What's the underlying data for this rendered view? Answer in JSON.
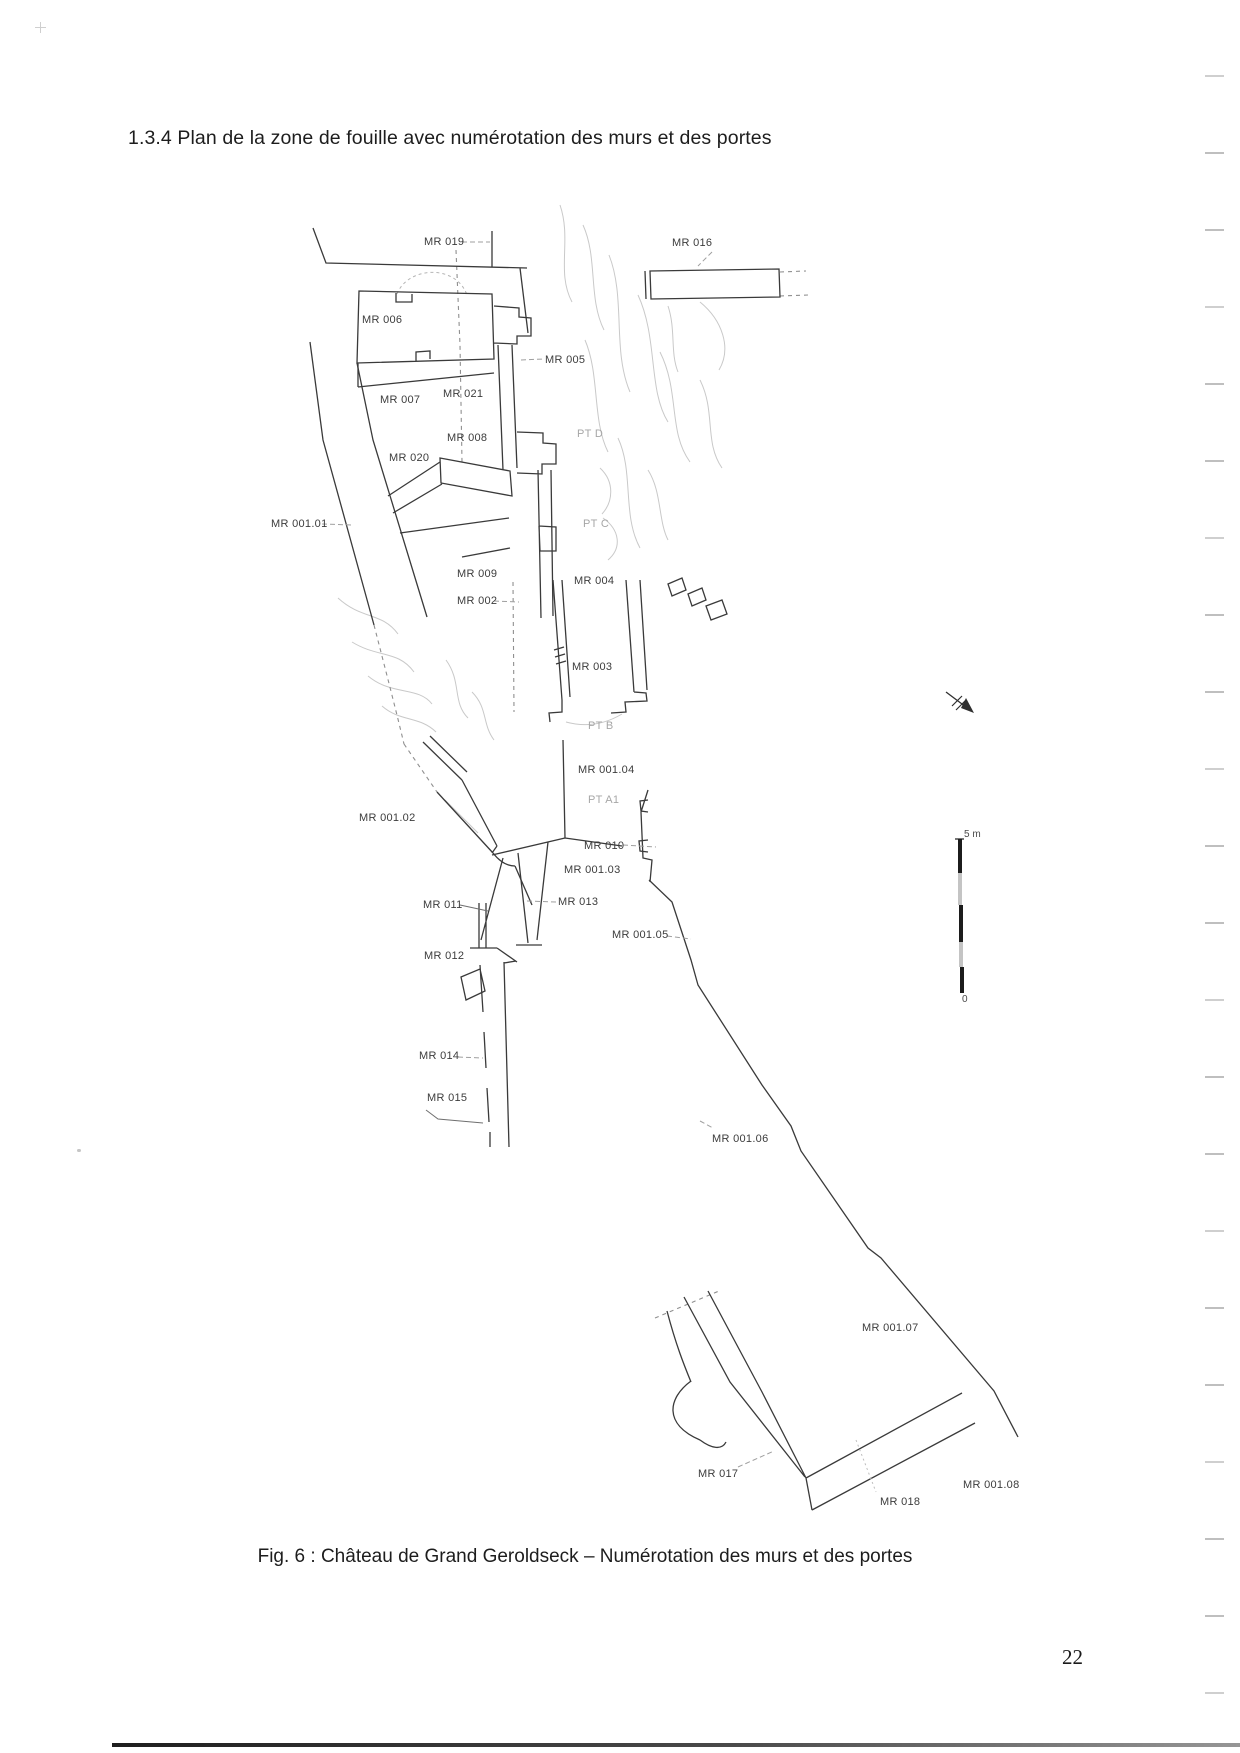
{
  "page": {
    "heading": "1.3.4 Plan de la zone de fouille avec numérotation des murs et des portes",
    "caption": "Fig. 6 : Château de Grand Geroldseck – Numérotation des murs et des portes",
    "page_number": "22",
    "scan_artifacts": {
      "edge_dash_count": 22,
      "edge_dash_start_y": 75,
      "edge_dash_step_y": 77
    }
  },
  "figure": {
    "type": "excavation-plan-line-drawing",
    "has_north_arrow": true,
    "scale_bar": {
      "top_label": "5 m",
      "bottom_label": "0",
      "length_m": 5
    },
    "labels": [
      {
        "name": "label-mr-019",
        "text": "MR 019",
        "x": 424,
        "y": 236,
        "tone": "dark"
      },
      {
        "name": "label-mr-016",
        "text": "MR 016",
        "x": 672,
        "y": 237,
        "tone": "dark"
      },
      {
        "name": "label-mr-006",
        "text": "MR 006",
        "x": 362,
        "y": 314,
        "tone": "dark"
      },
      {
        "name": "label-mr-005",
        "text": "MR 005",
        "x": 545,
        "y": 354,
        "tone": "dark"
      },
      {
        "name": "label-mr-007",
        "text": "MR 007",
        "x": 380,
        "y": 394,
        "tone": "dark"
      },
      {
        "name": "label-mr-021",
        "text": "MR 021",
        "x": 443,
        "y": 388,
        "tone": "dark"
      },
      {
        "name": "label-mr-008",
        "text": "MR 008",
        "x": 447,
        "y": 432,
        "tone": "dark"
      },
      {
        "name": "label-mr-020",
        "text": "MR 020",
        "x": 389,
        "y": 452,
        "tone": "dark"
      },
      {
        "name": "label-pt-d",
        "text": "PT D",
        "x": 577,
        "y": 428,
        "tone": "light"
      },
      {
        "name": "label-mr-001-01",
        "text": "MR 001.01",
        "x": 271,
        "y": 518,
        "tone": "dark"
      },
      {
        "name": "label-pt-c",
        "text": "PT C",
        "x": 583,
        "y": 518,
        "tone": "light"
      },
      {
        "name": "label-mr-009",
        "text": "MR 009",
        "x": 457,
        "y": 568,
        "tone": "dark"
      },
      {
        "name": "label-mr-004",
        "text": "MR 004",
        "x": 574,
        "y": 575,
        "tone": "dark"
      },
      {
        "name": "label-mr-002",
        "text": "MR 002",
        "x": 457,
        "y": 595,
        "tone": "dark"
      },
      {
        "name": "label-mr-003",
        "text": "MR 003",
        "x": 572,
        "y": 661,
        "tone": "dark"
      },
      {
        "name": "label-pt-b",
        "text": "PT B",
        "x": 588,
        "y": 720,
        "tone": "light"
      },
      {
        "name": "label-mr-001-04",
        "text": "MR 001.04",
        "x": 578,
        "y": 764,
        "tone": "dark"
      },
      {
        "name": "label-pt-a1",
        "text": "PT A1",
        "x": 588,
        "y": 794,
        "tone": "light"
      },
      {
        "name": "label-mr-001-02",
        "text": "MR 001.02",
        "x": 359,
        "y": 812,
        "tone": "dark"
      },
      {
        "name": "label-mr-010",
        "text": "MR 010",
        "x": 584,
        "y": 840,
        "tone": "dark"
      },
      {
        "name": "label-mr-001-03",
        "text": "MR 001.03",
        "x": 564,
        "y": 864,
        "tone": "dark"
      },
      {
        "name": "label-mr-011",
        "text": "MR 011",
        "x": 423,
        "y": 899,
        "tone": "dark"
      },
      {
        "name": "label-mr-013",
        "text": "MR 013",
        "x": 558,
        "y": 896,
        "tone": "dark"
      },
      {
        "name": "label-mr-001-05",
        "text": "MR 001.05",
        "x": 612,
        "y": 929,
        "tone": "dark"
      },
      {
        "name": "label-mr-012",
        "text": "MR 012",
        "x": 424,
        "y": 950,
        "tone": "dark"
      },
      {
        "name": "label-mr-014",
        "text": "MR 014",
        "x": 419,
        "y": 1050,
        "tone": "dark"
      },
      {
        "name": "label-mr-015",
        "text": "MR 015",
        "x": 427,
        "y": 1092,
        "tone": "dark"
      },
      {
        "name": "label-mr-001-06",
        "text": "MR 001.06",
        "x": 712,
        "y": 1133,
        "tone": "dark"
      },
      {
        "name": "label-mr-001-07",
        "text": "MR 001.07",
        "x": 862,
        "y": 1322,
        "tone": "dark"
      },
      {
        "name": "label-mr-017",
        "text": "MR 017",
        "x": 698,
        "y": 1468,
        "tone": "dark"
      },
      {
        "name": "label-mr-018",
        "text": "MR 018",
        "x": 880,
        "y": 1496,
        "tone": "dark"
      },
      {
        "name": "label-mr-001-08",
        "text": "MR 001.08",
        "x": 963,
        "y": 1479,
        "tone": "dark"
      }
    ]
  },
  "colors": {
    "paper": "#ffffff",
    "ink": "#3a3a3a",
    "muted_label": "#a6a6a6",
    "rubble_line": "#c9c9c9"
  }
}
